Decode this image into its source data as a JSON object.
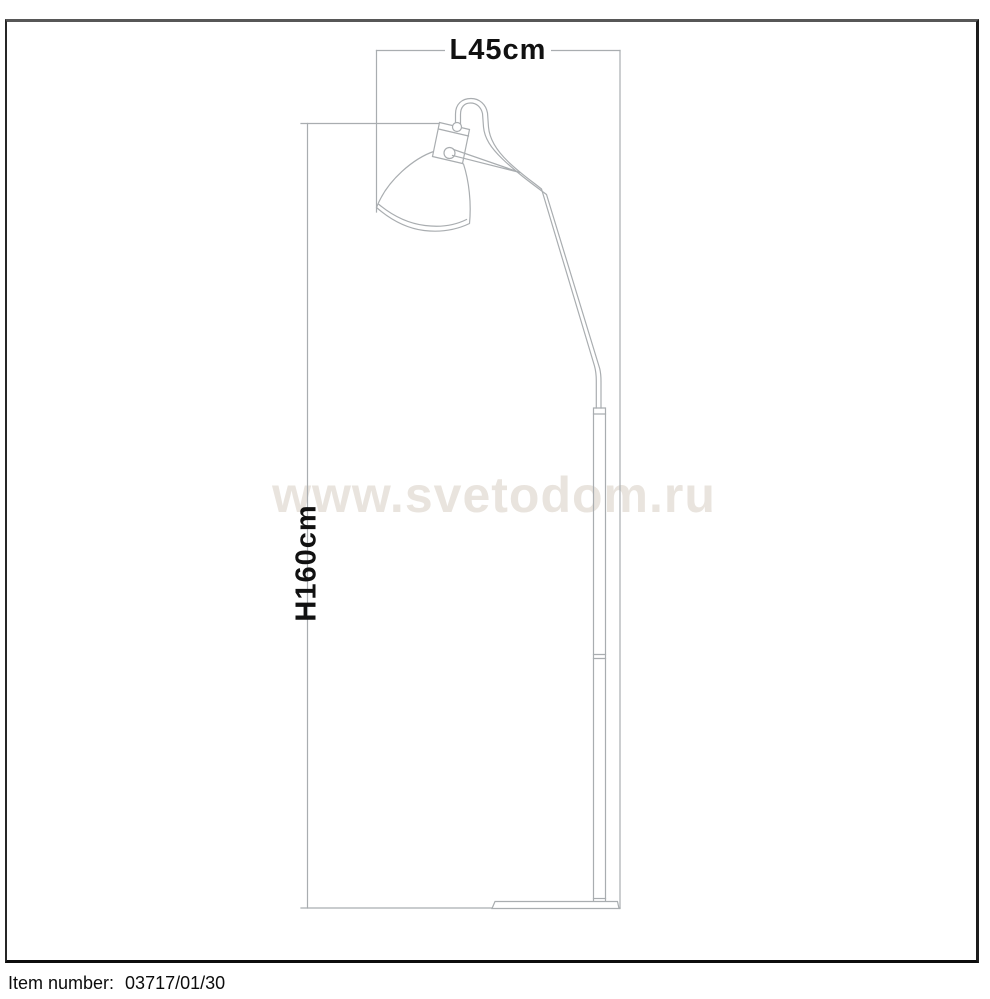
{
  "dimensions": {
    "length": {
      "label": "L45cm",
      "value_cm": 45
    },
    "height": {
      "label": "H160cm",
      "value_cm": 160
    }
  },
  "watermark": {
    "text": "www.svetodom.ru",
    "color": "#e9e4de"
  },
  "footer": {
    "label": "Item number:",
    "value": "03717/01/30"
  },
  "drawing": {
    "subject": "floor-lamp-technical-drawing",
    "line_color": "#a9adb0",
    "label_color": "#111111"
  }
}
